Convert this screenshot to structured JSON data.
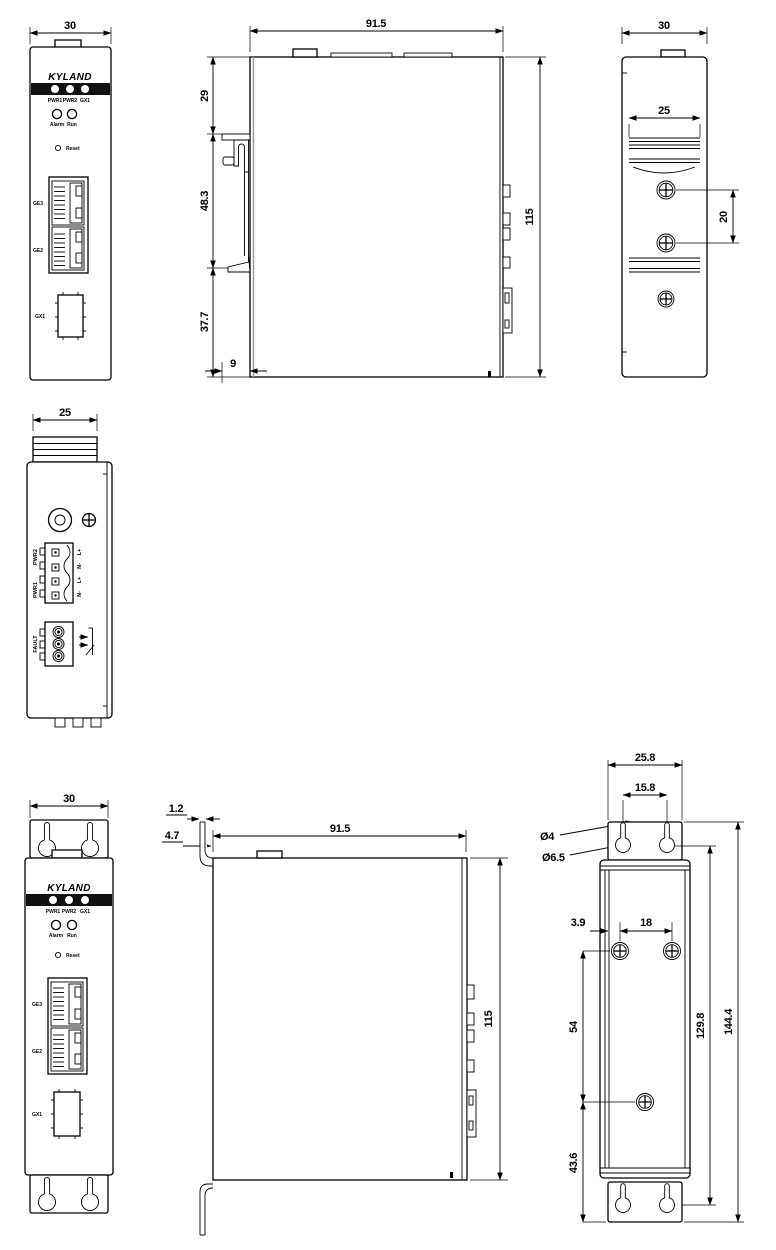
{
  "drawing": {
    "brand": "KYLAND",
    "panel": {
      "logo": "KYLAND",
      "led1": "PWR1",
      "led2": "PWR2",
      "led3": "GX1",
      "alarm": "Alarm",
      "run": "Run",
      "reset": "Reset",
      "ge3": "GE3",
      "ge2": "GE2",
      "gx1": "GX1"
    },
    "din": {
      "front": {
        "width": "30"
      },
      "side": {
        "width": "91.5",
        "seg_top": "29",
        "seg_mid": "48.3",
        "seg_bot": "37.7",
        "foot": "9",
        "height": "115"
      },
      "rear": {
        "width": "30",
        "rail_width": "25",
        "screw_gap": "20"
      }
    },
    "bottom_view": {
      "width": "25",
      "pwr2": "PWR2",
      "pwr1": "PWR1",
      "fault": "FAULT",
      "pin1": "L+",
      "pin2": "N-",
      "pin3": "L+",
      "pin4": "N-"
    },
    "wall": {
      "front": {
        "width": "30"
      },
      "side": {
        "thickness": "1.2",
        "offset": "4.7",
        "width": "91.5",
        "height": "115"
      },
      "rear": {
        "width": "25.8",
        "slot_gap": "15.8",
        "slot_dia": "Ø4",
        "hole_dia": "Ø6.5",
        "edge": "3.9",
        "screw_gap": "18",
        "screw_span": "54",
        "hole_span": "129.8",
        "height": "144.4",
        "bottom_span": "43.6"
      }
    }
  }
}
